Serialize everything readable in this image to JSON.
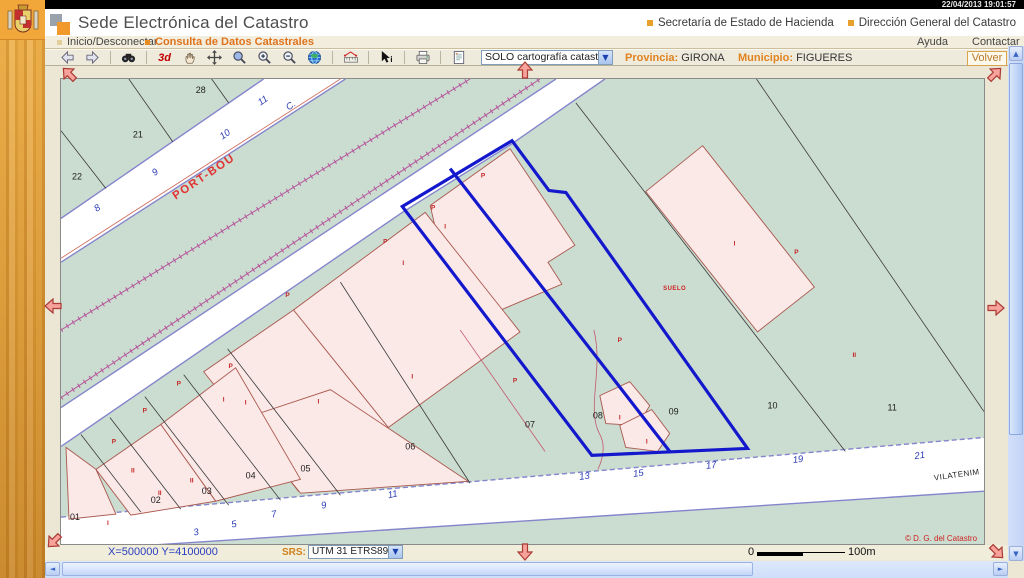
{
  "titlebar": {
    "timestamp": "22/04/2013 19:01:57"
  },
  "header": {
    "title": "Sede Electrónica del Catastro",
    "links": [
      {
        "label": "Secretaría de Estado de Hacienda"
      },
      {
        "label": "Dirección General del Catastro"
      }
    ]
  },
  "menubar": {
    "items": [
      {
        "label": "Inicio/Desconectar"
      },
      {
        "label": "Consulta de Datos Catastrales"
      }
    ],
    "right_items": [
      {
        "label": "Ayuda"
      },
      {
        "label": "Contactar"
      }
    ]
  },
  "toolbar": {
    "label_3d": "3d",
    "layer_select": {
      "value": "SOLO cartografía catastral"
    },
    "provincia_label": "Provincia:",
    "provincia_value": "GIRONA",
    "municipio_label": "Municipio:",
    "municipio_value": "FIGUERES",
    "volver_label": "Volver"
  },
  "statusbar": {
    "coordinates": "X=500000 Y=4100000",
    "srs_label": "SRS:",
    "srs_value": "UTM 31 ETRS89",
    "scale": {
      "start": "0",
      "end": "100m"
    }
  },
  "colors": {
    "accent_orange": "#e07820",
    "selection_blue": "#1418cc",
    "map_green": "#cbdcd0",
    "building_pink": "#fbe9e8",
    "railway_magenta": "#b5549b",
    "street_edge_purple": "#8585cd"
  },
  "map": {
    "labels": [
      {
        "k": "parcel",
        "t": "28",
        "x": 140,
        "y": 14
      },
      {
        "k": "parcel",
        "t": "21",
        "x": 77,
        "y": 59
      },
      {
        "k": "parcel",
        "t": "22",
        "x": 16,
        "y": 101
      },
      {
        "k": "parcel",
        "t": "01",
        "x": 14,
        "y": 443
      },
      {
        "k": "parcel",
        "t": "02",
        "x": 95,
        "y": 426
      },
      {
        "k": "parcel",
        "t": "03",
        "x": 146,
        "y": 417
      },
      {
        "k": "parcel",
        "t": "04",
        "x": 190,
        "y": 401
      },
      {
        "k": "parcel",
        "t": "05",
        "x": 245,
        "y": 394
      },
      {
        "k": "parcel",
        "t": "06",
        "x": 350,
        "y": 372
      },
      {
        "k": "parcel",
        "t": "07",
        "x": 470,
        "y": 350
      },
      {
        "k": "parcel",
        "t": "08",
        "x": 538,
        "y": 341
      },
      {
        "k": "parcel",
        "t": "09",
        "x": 614,
        "y": 337
      },
      {
        "k": "parcel",
        "t": "10",
        "x": 713,
        "y": 331
      },
      {
        "k": "parcel",
        "t": "11",
        "x": 833,
        "y": 333
      },
      {
        "k": "snum",
        "t": "8",
        "x": 38,
        "y": 132,
        "r": -35
      },
      {
        "k": "snum",
        "t": "9",
        "x": 96,
        "y": 96,
        "r": -35
      },
      {
        "k": "snum",
        "t": "10",
        "x": 166,
        "y": 58,
        "r": -35
      },
      {
        "k": "snum",
        "t": "11",
        "x": 204,
        "y": 24,
        "r": -35
      },
      {
        "k": "snum",
        "t": "C.",
        "x": 232,
        "y": 29,
        "r": -35
      },
      {
        "k": "snum",
        "t": "3",
        "x": 136,
        "y": 458,
        "r": -12
      },
      {
        "k": "snum",
        "t": "5",
        "x": 174,
        "y": 450,
        "r": -12
      },
      {
        "k": "snum",
        "t": "7",
        "x": 214,
        "y": 440,
        "r": -12
      },
      {
        "k": "snum",
        "t": "9",
        "x": 264,
        "y": 431,
        "r": -12
      },
      {
        "k": "snum",
        "t": "11",
        "x": 333,
        "y": 420,
        "r": -12
      },
      {
        "k": "snum",
        "t": "13",
        "x": 525,
        "y": 402,
        "r": -8
      },
      {
        "k": "snum",
        "t": "15",
        "x": 579,
        "y": 399,
        "r": -8
      },
      {
        "k": "snum",
        "t": "17",
        "x": 652,
        "y": 391,
        "r": -8
      },
      {
        "k": "snum",
        "t": "19",
        "x": 739,
        "y": 385,
        "r": -8
      },
      {
        "k": "snum",
        "t": "21",
        "x": 861,
        "y": 381,
        "r": -8
      },
      {
        "k": "mark",
        "t": "P",
        "x": 423,
        "y": 99
      },
      {
        "k": "mark",
        "t": "P",
        "x": 373,
        "y": 131
      },
      {
        "k": "mark",
        "t": "P",
        "x": 325,
        "y": 165
      },
      {
        "k": "mark",
        "t": "P",
        "x": 227,
        "y": 219
      },
      {
        "k": "mark",
        "t": "P",
        "x": 170,
        "y": 290
      },
      {
        "k": "mark",
        "t": "P",
        "x": 118,
        "y": 308
      },
      {
        "k": "mark",
        "t": "P",
        "x": 84,
        "y": 335
      },
      {
        "k": "mark",
        "t": "P",
        "x": 53,
        "y": 366
      },
      {
        "k": "mark",
        "t": "P",
        "x": 455,
        "y": 305
      },
      {
        "k": "mark",
        "t": "P",
        "x": 560,
        "y": 264
      },
      {
        "k": "mark",
        "t": "P",
        "x": 737,
        "y": 176
      },
      {
        "k": "mark",
        "t": "I",
        "x": 385,
        "y": 150
      },
      {
        "k": "mark",
        "t": "I",
        "x": 343,
        "y": 187
      },
      {
        "k": "mark",
        "t": "I",
        "x": 163,
        "y": 324
      },
      {
        "k": "mark",
        "t": "I",
        "x": 185,
        "y": 327
      },
      {
        "k": "mark",
        "t": "I",
        "x": 258,
        "y": 326
      },
      {
        "k": "mark",
        "t": "I",
        "x": 352,
        "y": 301
      },
      {
        "k": "mark",
        "t": "I",
        "x": 675,
        "y": 167
      },
      {
        "k": "mark",
        "t": "I",
        "x": 47,
        "y": 448
      },
      {
        "k": "mark",
        "t": "I",
        "x": 560,
        "y": 342
      },
      {
        "k": "mark",
        "t": "I",
        "x": 587,
        "y": 366
      },
      {
        "k": "mark",
        "t": "II",
        "x": 72,
        "y": 395
      },
      {
        "k": "mark",
        "t": "II",
        "x": 99,
        "y": 418
      },
      {
        "k": "mark",
        "t": "II",
        "x": 131,
        "y": 405
      },
      {
        "k": "mark",
        "t": "II",
        "x": 795,
        "y": 279
      },
      {
        "k": "street1",
        "t": "PORT-BOU",
        "x": 145,
        "y": 101,
        "r": -34
      },
      {
        "k": "street2",
        "t": "VILATENIM",
        "x": 898,
        "y": 400,
        "r": -8
      },
      {
        "k": "suelo",
        "t": "SUELO",
        "x": 615,
        "y": 212
      },
      {
        "k": "copy",
        "t": "© D. G. del Catastro",
        "x": 918,
        "y": 464
      }
    ]
  }
}
